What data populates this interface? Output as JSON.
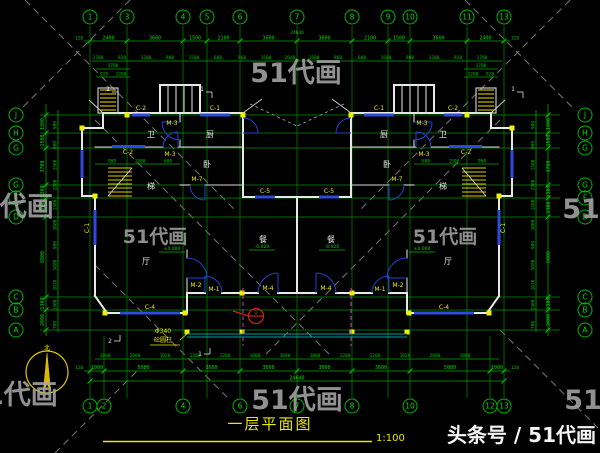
{
  "watermarks": {
    "tile_text": "51代画",
    "byline": "头条号 / 51代画"
  },
  "title": {
    "text": "一层平面图",
    "scale": "1:100"
  },
  "grid": {
    "top_numbers": [
      "1",
      "3",
      "4",
      "5",
      "6",
      "7",
      "8",
      "9",
      "10",
      "11",
      "13"
    ],
    "bottom_numbers": [
      "1",
      "2",
      "4",
      "6",
      "7",
      "8",
      "10",
      "12",
      "13"
    ],
    "left_letters": [
      "J",
      "H",
      "G",
      "G",
      "F",
      "D",
      "C",
      "B",
      "A"
    ],
    "right_letters": [
      "J",
      "H",
      "G",
      "G",
      "F",
      "D",
      "C",
      "B",
      "A"
    ]
  },
  "dimensions": {
    "top_total": "24640",
    "top_main": [
      "2400",
      "3600",
      "1500",
      "2100",
      "3600",
      "3600",
      "2100",
      "1500",
      "3600",
      "2400"
    ],
    "top_ends": [
      "120",
      "120"
    ],
    "top_fine": [
      "1780",
      "920",
      "1200",
      "900",
      "1500",
      "600",
      "960",
      "1500",
      "2640",
      "1500",
      "960",
      "600",
      "1500",
      "900",
      "1200",
      "920",
      "1780"
    ],
    "terrace": [
      "1780",
      "920",
      "1200"
    ],
    "bottom_total": "24640",
    "bottom_main": [
      "1000",
      "5080",
      "3600",
      "3600",
      "3600",
      "3600",
      "5080",
      "1000"
    ],
    "bottom_ends": [
      "120",
      "120"
    ],
    "bottom_fine": [
      "1000",
      "2080",
      "1020",
      "1200",
      "1200",
      "1000",
      "3600",
      "1000",
      "1200",
      "1200",
      "1020",
      "2080",
      "1000"
    ],
    "left_main": [
      "1800",
      "1500",
      "3700",
      "1300",
      "1900",
      "8000",
      "1300",
      "2000"
    ],
    "left_fine": [
      "900",
      "900",
      "1500",
      "2200",
      "1300",
      "1000",
      "900",
      "5080",
      "1020",
      "1300",
      "700"
    ],
    "right_main": [
      "1800",
      "1500",
      "3700",
      "1300",
      "1900",
      "8000",
      "1300",
      "2000"
    ],
    "right_fine": [
      "900",
      "900",
      "1500",
      "2200",
      "1300",
      "1000",
      "900",
      "5080",
      "1020",
      "1300",
      "700"
    ],
    "interior_left": [
      "900",
      "1500",
      "600"
    ],
    "interior_right": [
      "600",
      "1500",
      "900"
    ]
  },
  "openings": {
    "doors": {
      "m1": "M-1",
      "m2": "M-2",
      "m3": "M-3",
      "m4": "M-4",
      "m7": "M-7"
    },
    "windows": {
      "c1": "C-1",
      "c2": "C-2",
      "c4": "C-4",
      "c5": "C-5"
    }
  },
  "rooms": {
    "bath": "卫",
    "kitchen": "厨",
    "stair": "梯",
    "bedroom": "卧",
    "living": "厅",
    "dining": "餐"
  },
  "annotations": {
    "north": "北",
    "level_zero": "±0.000",
    "level_neg": "-0.020",
    "column_note_1": "Φ340",
    "column_note_2": "砼圆柱",
    "detail_no": "1",
    "section_1": "1",
    "section_2": "2"
  }
}
